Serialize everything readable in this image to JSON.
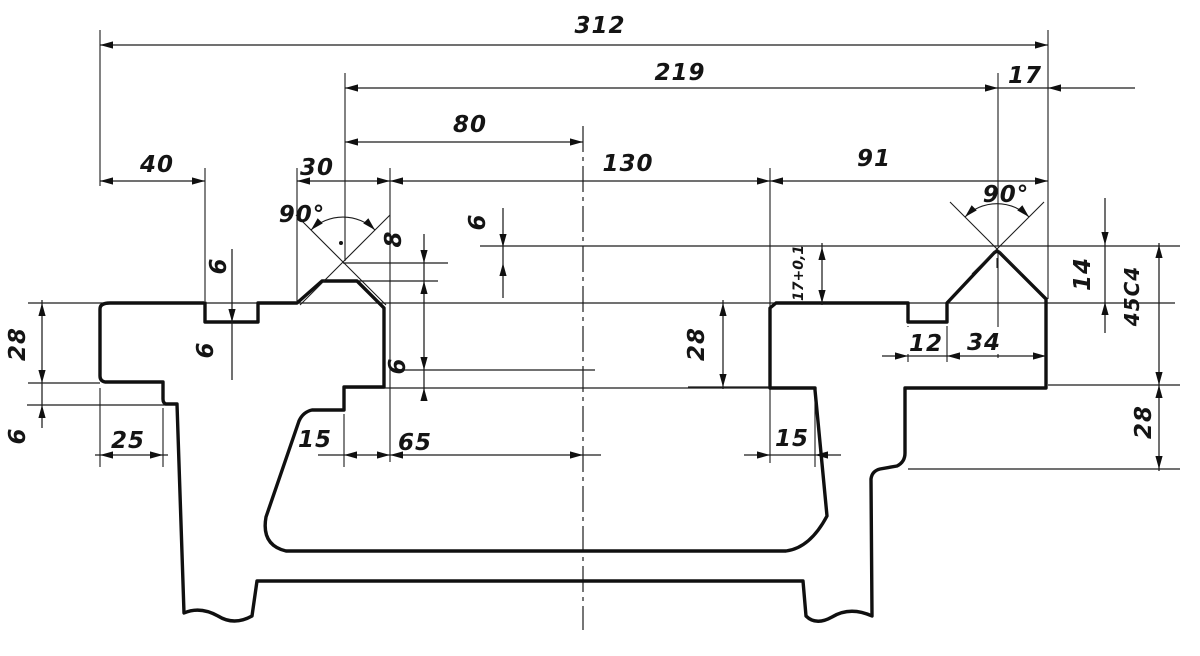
{
  "drawing": {
    "kind": "machine-bed cross-section",
    "ink": "#141414",
    "paper": "#ffffff",
    "dims": {
      "d312": "312",
      "d219": "219",
      "d17": "17",
      "d80": "80",
      "d130": "130",
      "d91": "91",
      "d40": "40",
      "d30": "30",
      "ang_l": "90°",
      "ang_r": "90°",
      "d6_notch": "6",
      "d6_inset": "6",
      "d8_ridge": "8",
      "d6_apex": "6",
      "d6_under": "6",
      "d28_flange": "28",
      "d6_flange": "6",
      "d25": "25",
      "d15_l": "15",
      "d65": "65",
      "d15_r": "15",
      "d12": "12",
      "d34": "34",
      "d28_slab": "28",
      "d17_tol": "17+0,1",
      "d14": "14",
      "d45c4": "45C4",
      "d28_leg": "28"
    }
  }
}
